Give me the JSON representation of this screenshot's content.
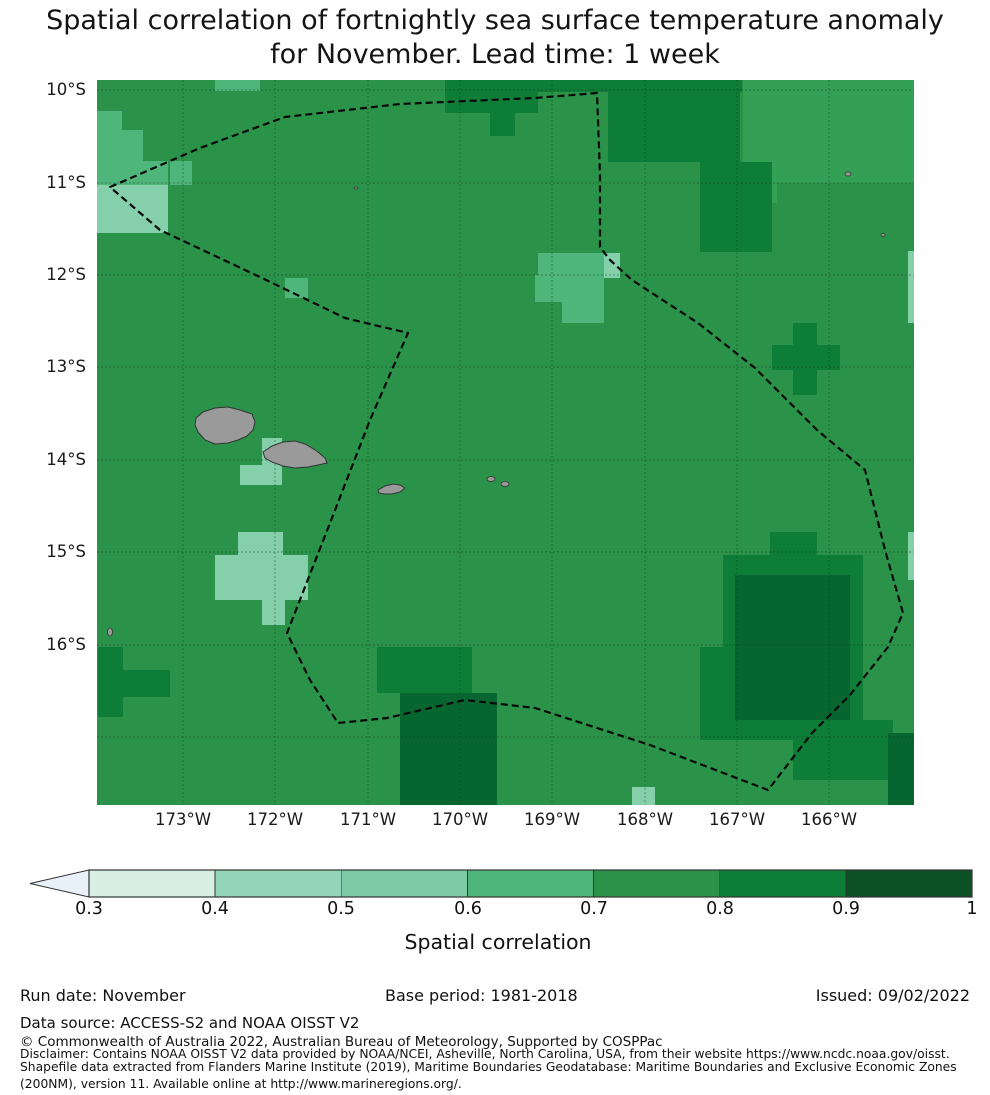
{
  "title": {
    "line1": "Spatial correlation of fortnightly sea surface temperature anomaly",
    "line2": "for November. Lead time: 1 week"
  },
  "map": {
    "width": 817,
    "height": 725,
    "base_color": "#2b9249",
    "grid_color": "#123a1f",
    "x_ticks": [
      {
        "label": "173°W",
        "x": 183
      },
      {
        "label": "172°W",
        "x": 275
      },
      {
        "label": "171°W",
        "x": 368
      },
      {
        "label": "170°W",
        "x": 460
      },
      {
        "label": "169°W",
        "x": 552
      },
      {
        "label": "168°W",
        "x": 645
      },
      {
        "label": "167°W",
        "x": 737
      },
      {
        "label": "166°W",
        "x": 829
      }
    ],
    "y_ticks": [
      {
        "label": "10°S",
        "y": 90
      },
      {
        "label": "11°S",
        "y": 183
      },
      {
        "label": "12°S",
        "y": 275
      },
      {
        "label": "13°S",
        "y": 367
      },
      {
        "label": "14°S",
        "y": 460
      },
      {
        "label": "15°S",
        "y": 552
      },
      {
        "label": "16°S",
        "y": 645
      }
    ],
    "grid_x": [
      86,
      178,
      271,
      363,
      455,
      548,
      640,
      732
    ],
    "grid_y": [
      10,
      103,
      195,
      287,
      380,
      472,
      565,
      657
    ],
    "bands": {
      "b05": "#85cfab",
      "b06": "#4fb67b",
      "b06t": "#33a055",
      "b08": "#0d7d37",
      "b09": "#076630"
    },
    "band_order": [
      "b06t",
      "b05",
      "b06",
      "b08",
      "b09"
    ],
    "patches": {
      "b06t": [
        [
          646,
          0,
          171,
          103
        ],
        [
          651,
          103,
          29,
          20
        ]
      ],
      "b05": [
        [
          0,
          105,
          71,
          48
        ],
        [
          141,
          452,
          45,
          23
        ],
        [
          118,
          475,
          93,
          45
        ],
        [
          165,
          520,
          23,
          25
        ],
        [
          165,
          358,
          20,
          29
        ],
        [
          143,
          385,
          42,
          20
        ],
        [
          811,
          171,
          6,
          72
        ],
        [
          811,
          452,
          6,
          48
        ],
        [
          535,
          707,
          23,
          18
        ],
        [
          465,
          173,
          58,
          25
        ]
      ],
      "b06": [
        [
          0,
          31,
          25,
          19
        ],
        [
          0,
          50,
          46,
          31
        ],
        [
          0,
          81,
          71,
          24
        ],
        [
          73,
          81,
          22,
          24
        ],
        [
          118,
          0,
          45,
          11
        ],
        [
          188,
          198,
          23,
          20
        ],
        [
          441,
          173,
          66,
          47
        ],
        [
          465,
          220,
          42,
          23
        ],
        [
          438,
          195,
          27,
          27
        ]
      ],
      "b08": [
        [
          348,
          0,
          297,
          12
        ],
        [
          348,
          12,
          93,
          21
        ],
        [
          393,
          33,
          25,
          23
        ],
        [
          511,
          12,
          132,
          70
        ],
        [
          603,
          82,
          72,
          90
        ],
        [
          696,
          243,
          24,
          72
        ],
        [
          675,
          265,
          68,
          25
        ],
        [
          1,
          567,
          25,
          70
        ],
        [
          25,
          590,
          48,
          27
        ],
        [
          280,
          567,
          95,
          46
        ],
        [
          673,
          452,
          47,
          23
        ],
        [
          626,
          475,
          140,
          165
        ],
        [
          603,
          567,
          97,
          93
        ],
        [
          696,
          640,
          100,
          60
        ]
      ],
      "b09": [
        [
          303,
          613,
          97,
          112
        ],
        [
          638,
          495,
          115,
          145
        ],
        [
          791,
          653,
          26,
          72
        ]
      ]
    },
    "eez_path": "M13,107 L103,68 L188,37 L303,24 L438,18 L500,13 L503,95 L503,167 L513,180 L535,200 L601,243 L658,288 L720,350 L768,390 L788,470 L806,533 L791,567 L753,615 L715,653 L671,710 L553,665 L438,628 L368,620 L290,638 L241,643 L213,600 L190,553 L233,443 L273,340 L311,253 L248,238 L165,198 L63,150 Z",
    "eez_color": "#0a0a0a",
    "island_fill": "#9a9a9a",
    "island_stroke": "#333333",
    "islands": [
      "99,338 106,332 118,328 131,327 143,330 155,334 158,342 156,350 150,356 141,360 131,363 118,364 108,360 101,352 98,345",
      "166,372 175,366 186,362 198,361 208,364 215,368 221,372 228,378 230,383 221,385 211,387 198,388 186,386 175,382 168,378",
      "281,410 288,406 296,404 303,405 308,408 303,412 295,414 287,414 282,413"
    ],
    "specks": [
      [
        394,
        399,
        4,
        2.5
      ],
      [
        408,
        404,
        4,
        2.5
      ],
      [
        751,
        94,
        3,
        2
      ],
      [
        786,
        155,
        2,
        1.5
      ],
      [
        259,
        108,
        2,
        1
      ],
      [
        13,
        552,
        2.5,
        4
      ]
    ]
  },
  "colorbar": {
    "label": "Spatial correlation",
    "ticks": [
      "0.3",
      "0.4",
      "0.5",
      "0.6",
      "0.7",
      "0.8",
      "0.9",
      "1"
    ],
    "tick_x": [
      89,
      215,
      341,
      468,
      594,
      720,
      846,
      972
    ],
    "segment_colors": [
      "#d8efe3",
      "#93d5b6",
      "#7dcaa4",
      "#4fb67b",
      "#2b9249",
      "#0d7d37",
      "#0c5026"
    ],
    "arrow_color": "#e8f1f9",
    "bar_x0": 89,
    "bar_x1": 972,
    "bar_y": 8,
    "bar_h": 27,
    "tip_x": 30,
    "edge_color": "#333333"
  },
  "footer": {
    "run_date": "Run date: November",
    "base_period": "Base period: 1981-2018",
    "issued": "Issued: 09/02/2022",
    "data_source": "Data source: ACCESS-S2 and NOAA OISST V2",
    "copyright": "© Commonwealth of Australia 2022, Australian Bureau of Meteorology, Supported by COSPPac",
    "disclaimer_line1": "Disclaimer: Contains NOAA OISST V2 data provided by NOAA/NCEI, Asheville, North Carolina, USA, from their website https://www.ncdc.noaa.gov/oisst.",
    "disclaimer_line2": "Shapefile data extracted from Flanders Marine Institute (2019), Maritime Boundaries Geodatabase: Maritime Boundaries and Exclusive Economic Zones",
    "disclaimer_line3": "(200NM), version 11. Available online at http://www.marineregions.org/."
  },
  "chart_data": {
    "type": "heatmap",
    "title": "Spatial correlation of fortnightly sea surface temperature anomaly for November. Lead time: 1 week",
    "x_tick_labels": [
      "173°W",
      "172°W",
      "171°W",
      "170°W",
      "169°W",
      "168°W",
      "167°W",
      "166°W"
    ],
    "y_tick_labels": [
      "10°S",
      "11°S",
      "12°S",
      "13°S",
      "14°S",
      "15°S",
      "16°S"
    ],
    "lon_range_deg_W": [
      173.9,
      165.1
    ],
    "lat_range_deg_S": [
      9.9,
      17.75
    ],
    "colorbar_label": "Spatial correlation",
    "colorbar_ticks": [
      0.3,
      0.4,
      0.5,
      0.6,
      0.7,
      0.8,
      0.9,
      1.0
    ],
    "colorbar_extend": "min",
    "dominant_value_band": "0.7-0.8",
    "notable_regions": [
      {
        "area": "far north-west near 10-11°S 173.5°W",
        "band": "0.5-0.7"
      },
      {
        "area": "north edge 168-169.5°W near 10°S",
        "band": "0.8-0.9"
      },
      {
        "area": "north-east of EEZ line 167.5-168.3°W 10-12°S",
        "band": "0.8-0.9"
      },
      {
        "area": "small cross near 12°S 168.2°W",
        "band": "0.5-0.7"
      },
      {
        "area": "plus shape near 13.1°S 166.9°W",
        "band": "0.8-0.9"
      },
      {
        "area": "patch near 15-15.5°S 171.8-172.7°W",
        "band": "0.5-0.6"
      },
      {
        "area": "cells just west/south-west of Upolu ~14.2°S 171.8°W",
        "band": "0.5-0.7"
      },
      {
        "area": "south-west corner 16-16.7°S 173.5°W",
        "band": "0.8-0.9"
      },
      {
        "area": "south-central column 16-17.7°S 169.6-170.8°W",
        "band": "0.8-1.0"
      },
      {
        "area": "large blob 15-17°S 166-167.5°W",
        "band": "0.8-1.0"
      }
    ],
    "overlays": [
      "dashed EEZ maritime boundary polygon",
      "Samoa islands (Savai'i, Upolu)",
      "Tutuila and small islets in grey"
    ]
  }
}
